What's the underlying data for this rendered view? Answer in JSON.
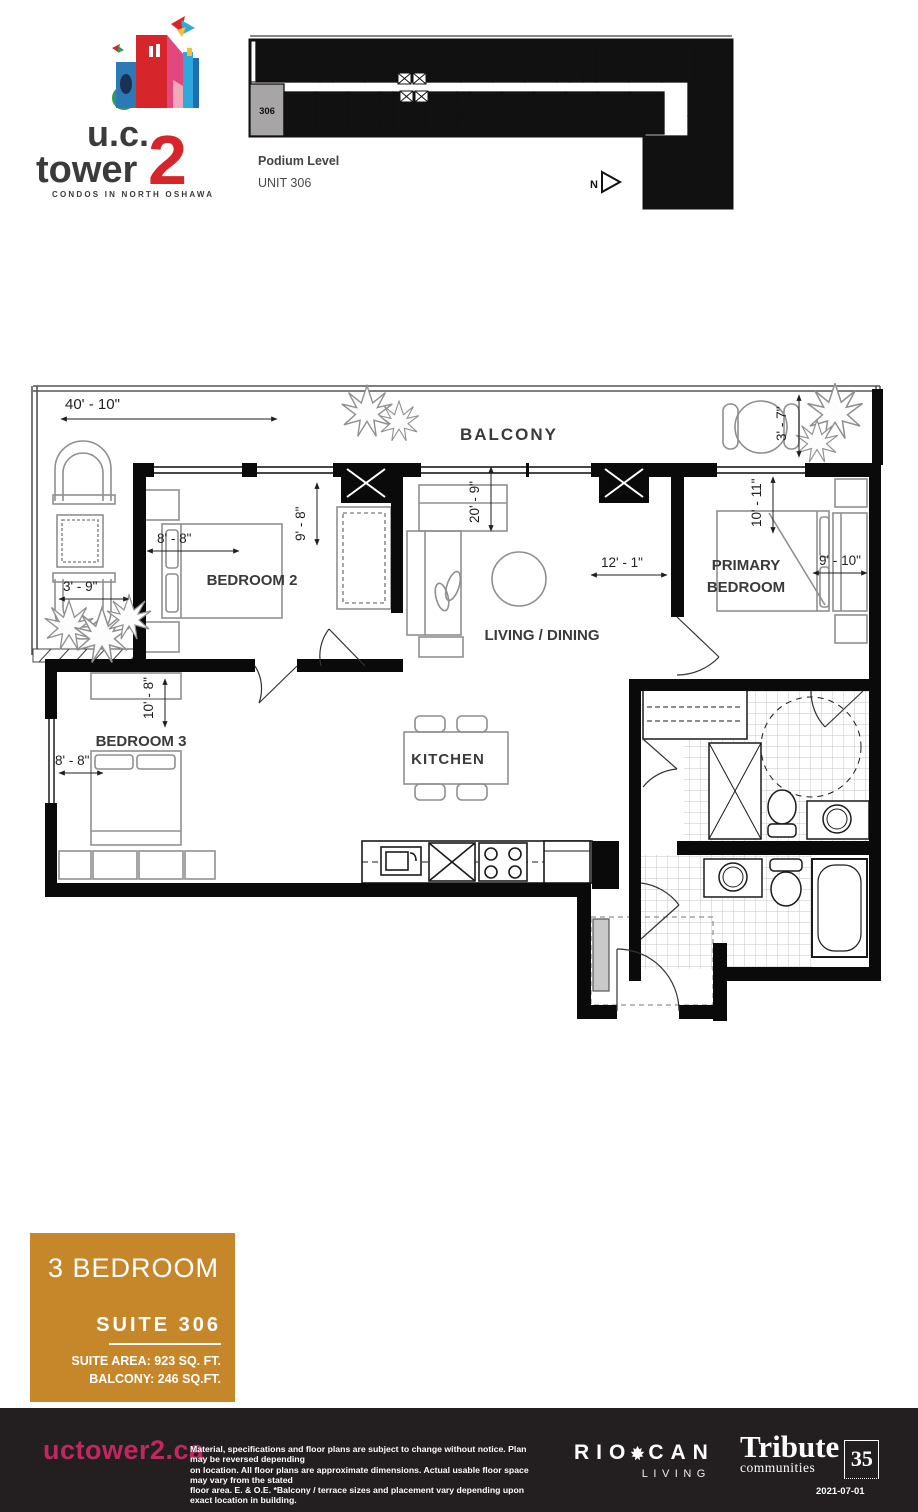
{
  "logo": {
    "brand_line1": "u.c.",
    "brand_line2": "tower",
    "brand_number": "2",
    "tagline": "CONDOS IN NORTH OSHAWA",
    "red": "#D6262C",
    "charcoal": "#3B3B3C"
  },
  "keyplan": {
    "level_label": "Podium Level",
    "unit_label": "UNIT 306",
    "north_label": "N",
    "highlighted_unit": "306",
    "units": {
      "u301": "301",
      "u302": "302",
      "u303": "303",
      "u304": "304",
      "u305": "305",
      "u306": "306",
      "u307": "307",
      "u308": "308",
      "u309": "309",
      "u310": "310",
      "u311": "311",
      "u312": "312",
      "u313": "313",
      "u314": "314",
      "u315": "315",
      "u316": "316",
      "u317": "317",
      "u318": "318",
      "u319": "319",
      "u320": "320",
      "u321": "321",
      "u322": "322",
      "u323": "323",
      "u324": "324",
      "u325": "325",
      "u326": "326",
      "u327": "327",
      "u328": "328",
      "u329": "329",
      "u330": "330",
      "u331": "331",
      "u332": "332",
      "u333": "333",
      "u334": "334",
      "u335": "335",
      "u336": "336",
      "u337": "337",
      "u338": "338"
    }
  },
  "plan": {
    "labels": {
      "balcony": "BALCONY",
      "bedroom2": "BEDROOM 2",
      "living_dining": "LIVING / DINING",
      "primary_line1": "PRIMARY",
      "primary_line2": "BEDROOM",
      "bedroom3": "BEDROOM 3",
      "kitchen": "KITCHEN"
    },
    "dims": {
      "overall_width": "40' - 10\"",
      "right_balcony_depth": "3' - 7\"",
      "left_balcony_width": "3' - 9\"",
      "bedroom2_depth": "9' - 8\"",
      "bedroom2_width": "8' - 8\"",
      "living_depth": "20' - 9\"",
      "living_width": "12' - 1\"",
      "primary_depth": "10' - 11\"",
      "primary_width": "9' - 10\"",
      "bedroom3_depth": "10' - 8\"",
      "bedroom3_width": "8' - 8\""
    }
  },
  "suite_info": {
    "type": "3 BEDROOM",
    "suite_label": "SUITE 306",
    "suite_area": "SUITE AREA: 923 SQ. FT.",
    "balcony_area": "BALCONY: 246 SQ.FT.",
    "box_color": "#C6872B"
  },
  "footer": {
    "website": "uctower2.ca",
    "website_color": "#C22761",
    "background": "#231F20",
    "disclaimer_line1": "Material, specifications and floor plans are subject to change without notice.  Plan may be reversed depending",
    "disclaimer_line2": "on location. All floor plans are approximate dimensions. Actual usable floor space may vary from the stated",
    "disclaimer_line3": "floor area.  E. & O.E.  *Balcony / terrace sizes and placement vary depending upon exact location in building.",
    "riocan_rio": "RIO",
    "riocan_can": "CAN",
    "riocan_living": "LIVING",
    "tribute_name": "Tribute",
    "tribute_sub": "communities",
    "tribute_years": "35",
    "date": "2021-07-01"
  }
}
